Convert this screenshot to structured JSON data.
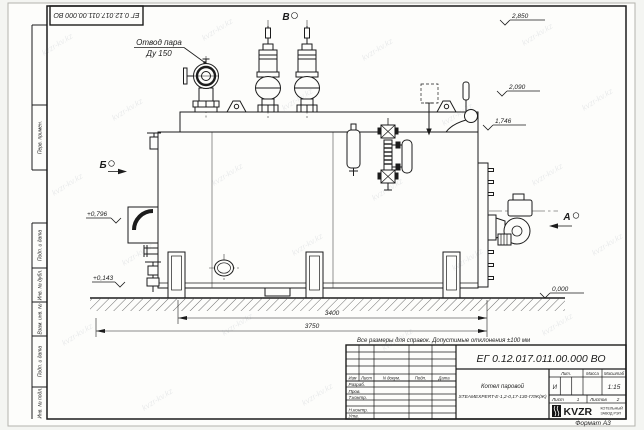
{
  "watermark": {
    "text": "kvzr-kv.kz"
  },
  "frame": {
    "designation_top": "ЕГ 0.12.017.011.00.000  ВО",
    "margin": {
      "perv": "Перв. примен.",
      "podp1": "Подп. и дата",
      "dubl": "Инв. № дубл.",
      "vzam": "Взам. инв. №",
      "podp2": "Подп. и дата",
      "podl": "Инв. № подл."
    },
    "format_note": "Формат А3"
  },
  "drawing": {
    "callout": {
      "line1": "Отвод пара",
      "line2": "Ду 150"
    },
    "views": {
      "top": "В",
      "left": "Б",
      "right": "А"
    },
    "elevations": {
      "e2850": "2,850",
      "e2090": "2,090",
      "e1746": "1,746",
      "e0000": "0,000",
      "e0796": "+0,796",
      "e0143": "+0,143"
    },
    "dimensions": {
      "d3400": "3400",
      "d3750": "3750"
    },
    "note": "Все размеры для справок. Допустимые отклонения ±100 мм"
  },
  "title_block": {
    "designation": "ЕГ 0.12.017.011.00.000  ВО",
    "header": {
      "izm": "Изм",
      "list": "Лист",
      "doc": "N докум.",
      "podp": "Подп.",
      "date": "Дата"
    },
    "roles": {
      "razrab": "Разраб.",
      "prov": "Пров.",
      "tkontr": "Т.контр.",
      "nkontr": "Н.контр.",
      "utv": "Утв."
    },
    "product": {
      "line1": "Котел паровой",
      "line2": "STEAMEXPERT-Е-1,2-0,17-130-ГЛЖ(Ж)"
    },
    "lit": {
      "label": "Лит.",
      "value": "И"
    },
    "massa": {
      "label": "Масса"
    },
    "scale": {
      "label": "Масштаб",
      "value": "1:15"
    },
    "sheet": {
      "list_label": "Лист",
      "list_value": "1",
      "listov_label": "Листов",
      "listov_value": "2"
    },
    "logo": {
      "name": "KVZR",
      "sub1": "КОТЕЛЬНЫЙ",
      "sub2": "ЗАВОД РЭП"
    }
  }
}
